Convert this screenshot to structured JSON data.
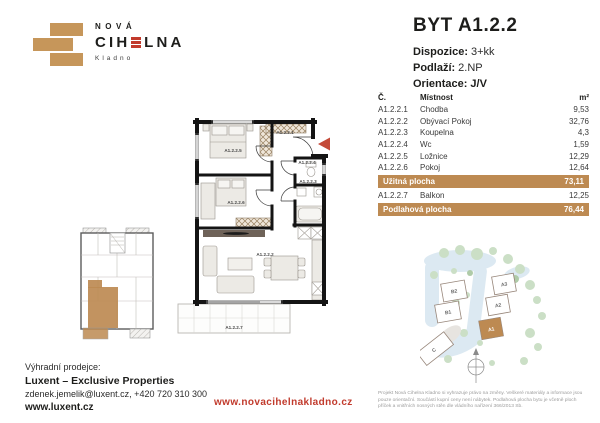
{
  "colors": {
    "brand_brick": "#BD8A52",
    "brand_red": "#C23A2C",
    "text_dark": "#1d1d1b",
    "disclaimer_gray": "#9c9c9c",
    "site_road_blue": "#DCE9F2",
    "site_tree_green": "#CBDFC6"
  },
  "logo": {
    "nova": "NOVÁ",
    "cihelna_left": "CIH",
    "cihelna_right": "LNA",
    "city": "Kladno"
  },
  "unit": {
    "title": "BYT A1.2.2",
    "fields": [
      {
        "label": "Dispozice:",
        "value": "3+kk"
      },
      {
        "label": "Podlaží:",
        "value": "2.NP"
      },
      {
        "label": "Orientace:",
        "value": "J/V"
      }
    ]
  },
  "area_table": {
    "col_num": "Č.",
    "col_room": "Místnost",
    "col_area": "m²",
    "rows": [
      {
        "num": "A1.2.2.1",
        "room": "Chodba",
        "area": "9,53"
      },
      {
        "num": "A1.2.2.2",
        "room": "Obývací Pokoj",
        "area": "32,76"
      },
      {
        "num": "A1.2.2.3",
        "room": "Koupelna",
        "area": "4,3"
      },
      {
        "num": "A1.2.2.4",
        "room": "Wc",
        "area": "1,59"
      },
      {
        "num": "A1.2.2.5",
        "room": "Ložnice",
        "area": "12,29"
      },
      {
        "num": "A1.2.2.6",
        "room": "Pokoj",
        "area": "12,64"
      }
    ],
    "usable": {
      "label": "Užitná plocha",
      "area": "73,11"
    },
    "balcony_row": {
      "num": "A1.2.2.7",
      "room": "Balkon",
      "area": "12,25"
    },
    "floor_total": {
      "label": "Podlahová plocha",
      "area": "76,44"
    }
  },
  "floor_plan": {
    "labels": [
      "A1.2.2.5",
      "A1.2.2.1",
      "A1.2.2.4",
      "A1.2.2.3",
      "A1.2.2.6",
      "A1.2.2.2",
      "A1.2.2.7"
    ]
  },
  "site_plan": {
    "buildings": [
      "B2",
      "B1",
      "A3",
      "A2",
      "A1",
      "C"
    ]
  },
  "footer": {
    "seller_label": "Výhradní prodejce:",
    "seller_name": "Luxent – Exclusive Properties",
    "seller_contact": "zdenek.jemelik@luxent.cz, +420 720 310 300",
    "seller_web": "www.luxent.cz",
    "project_web": "www.novacihelnakladno.cz",
    "disclaimer": "Projekt Nová Cihelna Kladno si vyhrazuje právo na změny. Veškeré materiály a informace jsou pouze orientační. Součástí kupní ceny není nábytek. Podlahová plocha bytu je včetně ploch příček a vnitřních nosných stěn dle vládního nařízení 366/2013 Sb."
  }
}
